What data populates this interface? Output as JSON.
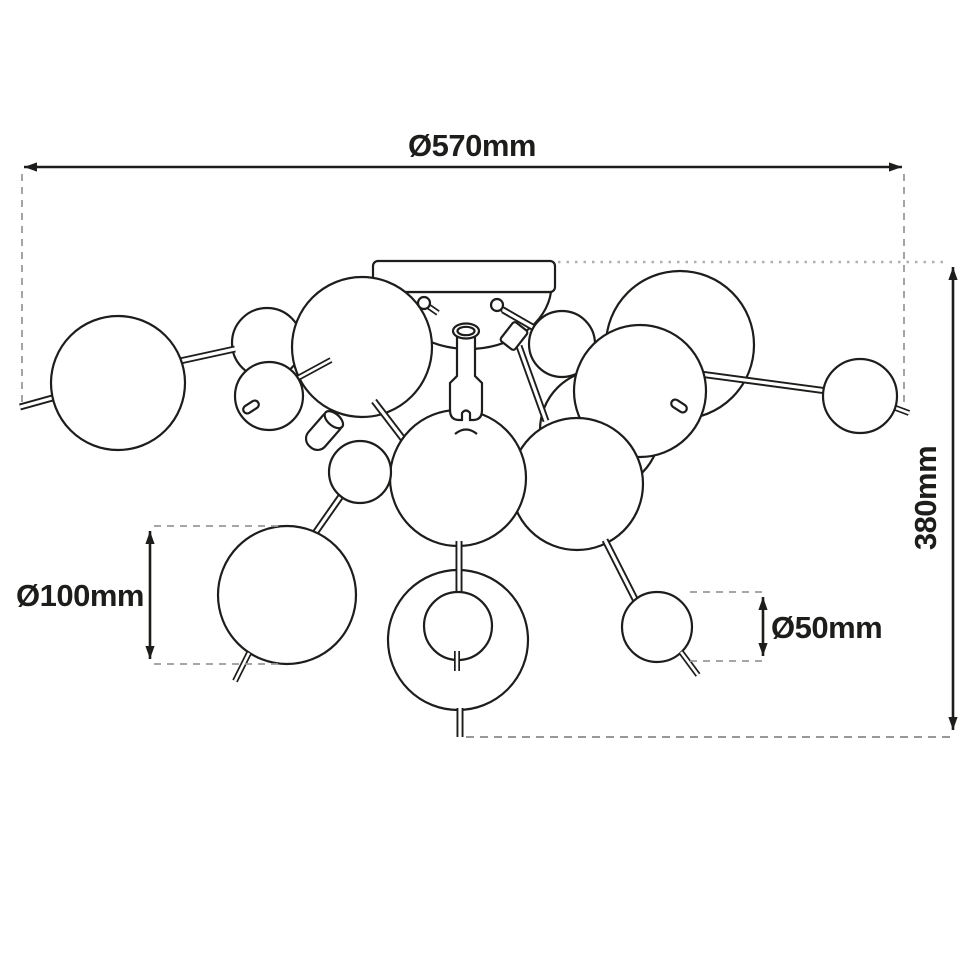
{
  "meta": {
    "background": "#ffffff",
    "stroke_color": "#1d1d1b",
    "guide_color": "#9a9a9a"
  },
  "drawing": {
    "subject": "Ceiling light fixture with glass bubble globes — dimensioned technical line drawing"
  },
  "dimensions": {
    "overall_diameter": {
      "label": "Ø570mm",
      "value": 570,
      "unit": "mm"
    },
    "fixture_height": {
      "label": "380mm",
      "value": 380,
      "unit": "mm"
    },
    "large_globe": {
      "label": "Ø100mm",
      "value": 100,
      "unit": "mm"
    },
    "small_globe": {
      "label": "Ø50mm",
      "value": 50,
      "unit": "mm"
    }
  }
}
